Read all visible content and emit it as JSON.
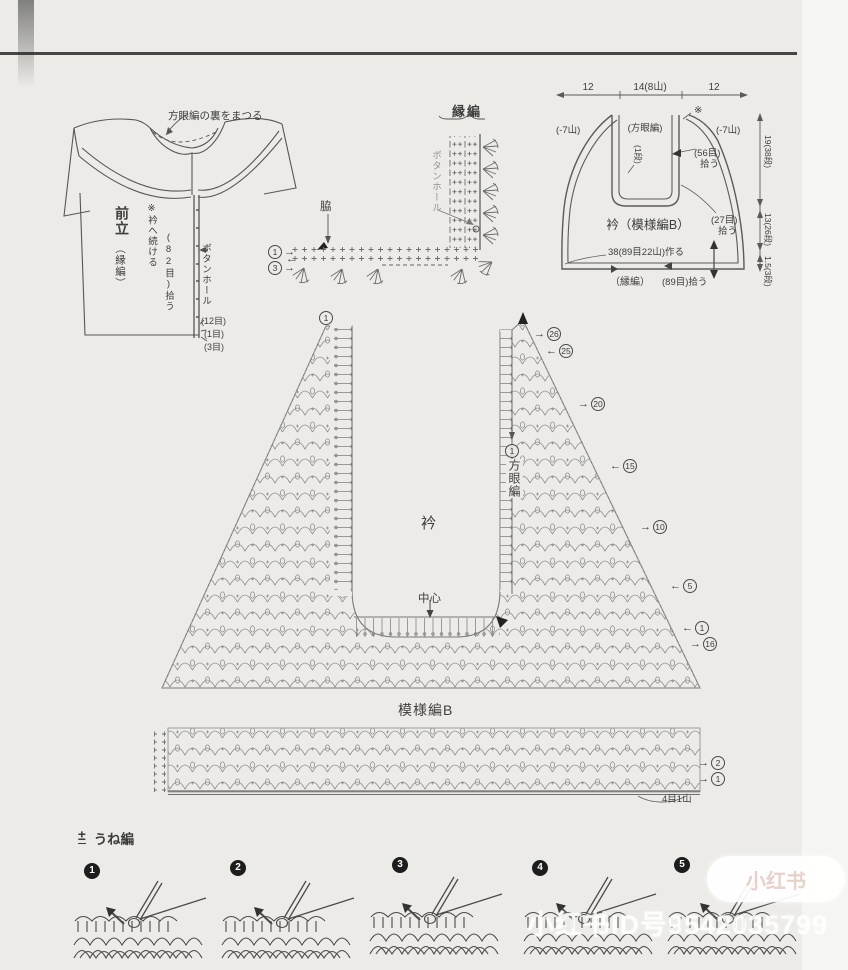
{
  "page": {
    "watermark_text": "小红书ID号9542035799",
    "watermark_badge": "小红书",
    "ink_color": "#3d3d3d",
    "bg_color": "#ecebe7"
  },
  "garment": {
    "top_note": "方眼編の裏をまつる",
    "name": "前立",
    "name_sub": "（縁編）",
    "continue_note": "※衿へ続ける",
    "pickup": "(82目)拾う",
    "buttonhole": "ボタンホール",
    "count_12": "(12目)",
    "count_1": "(1目)",
    "count_3": "(3目)"
  },
  "edge_chart": {
    "title": "縁編",
    "buttonhole": "ボタンホール",
    "side": "脇",
    "row1": {
      "num": "1",
      "arrow": "→"
    },
    "row2_arrow": "←",
    "row3": {
      "num": "3",
      "arrow": "→"
    }
  },
  "collar_schematic": {
    "dim_left": "12",
    "dim_center": "14(8山)",
    "dim_right": "12",
    "asterisk": "※",
    "minus_left": "(-7山)",
    "minus_right": "(-7山)",
    "grid_label": "(方眼編)",
    "one_row": "(1段)",
    "pickup56_a": "(56目)",
    "pickup56_b": "拾う",
    "title": "衿（模様編B）",
    "pickup27_a": "(27目)",
    "pickup27_b": "拾う",
    "make_note": "38(89目22山)作る",
    "edge_label": "（縁編）",
    "pickup89": "(89目)拾う",
    "dim_rows_1": "19(38段)",
    "dim_rows_2": "13(26段)",
    "dim_rows_3": "1.5(3段)"
  },
  "main_chart": {
    "left_apex_row": "1",
    "grid_row": "1",
    "grid_label": "方眼編",
    "collar_label": "衿",
    "center_label": "中心",
    "band_label": "模様編B",
    "band_note": "4目1山",
    "right_rows": [
      {
        "num": "26",
        "arrow": "→"
      },
      {
        "num": "25",
        "arrow": "←"
      },
      {
        "num": "20",
        "arrow": "→"
      },
      {
        "num": "15",
        "arrow": "←"
      },
      {
        "num": "10",
        "arrow": "→"
      },
      {
        "num": "5",
        "arrow": "←"
      },
      {
        "num": "1",
        "arrow": "←"
      },
      {
        "num": "16",
        "arrow": "→"
      }
    ],
    "band_rows": [
      {
        "num": "2",
        "arrow": "→"
      },
      {
        "num": "1",
        "arrow": "→"
      }
    ]
  },
  "steps": {
    "symbol": "±",
    "title": "うね編",
    "numbers": [
      "1",
      "2",
      "3",
      "4",
      "5"
    ]
  }
}
